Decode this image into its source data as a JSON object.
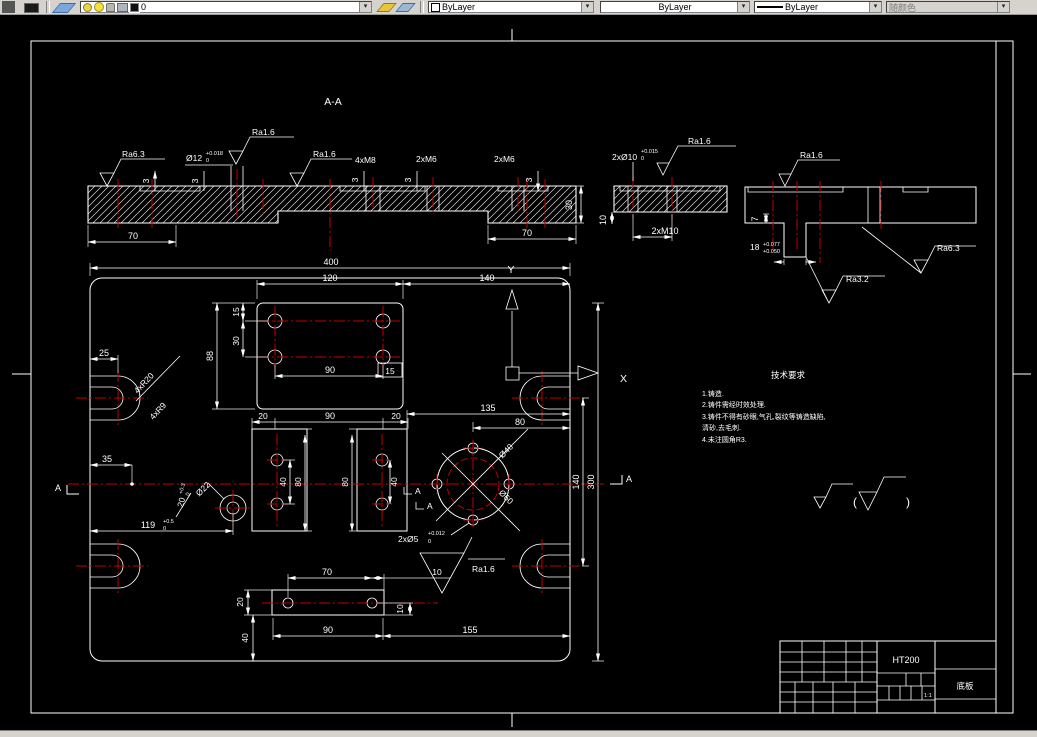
{
  "toolbar": {
    "layer_name": "0",
    "color": "ByLayer",
    "linetype": "ByLayer",
    "lineweight": "ByLayer",
    "plot_style": "随颜色",
    "dropdown_glyph": "▾"
  },
  "section": {
    "title": "A-A",
    "ra63": "Ra6.3",
    "ra16": "Ra1.6",
    "ra32": "Ra3.2",
    "dia12": "Ø12",
    "dia12_up": "+0.018",
    "dia12_dn": "0",
    "m8": "4xM8",
    "m6": "2xM6",
    "m10": "2xM10",
    "dia10": "2xØ10",
    "dia10_up": "+0.015",
    "dia10_dn": "0",
    "d3": "3",
    "d70": "70",
    "d30": "30",
    "d10": "10",
    "d7": "7",
    "d18": "18",
    "d18_up": "+0.077",
    "d18_dn": "+0.050"
  },
  "plan": {
    "d400": "400",
    "d120": "120",
    "d140": "140",
    "d300": "300",
    "d88": "88",
    "d15": "15",
    "d30": "30",
    "d25": "25",
    "d35": "35",
    "d119": "119",
    "d119_up": "+0.5",
    "d119_dn": "0",
    "d20": "20",
    "d20_up": "+0.3",
    "d20_dn": "0",
    "d40": "40",
    "d80": "80",
    "d90": "90",
    "d70": "70",
    "d10": "10",
    "d135": "135",
    "d155": "155",
    "r20": "4xR20",
    "r9": "4xR9",
    "dia40": "Ø40",
    "dia60": "Ø60",
    "dia22": "Ø22",
    "dia5": "2xØ5",
    "dia5_up": "+0.012",
    "dia5_dn": "0",
    "ra16": "Ra1.6",
    "axis_x": "X",
    "axis_y": "Y",
    "section_letter": "A",
    "paren_open": "(",
    "paren_close": ")"
  },
  "notes": {
    "title": "技术要求",
    "lines": [
      "1.铸造.",
      "2.铸件需经时效处理.",
      "3.铸件不得有砂眼,气孔,裂纹等铸造缺陷,",
      "清砂,去毛刺.",
      "4.未注圆角R3."
    ]
  },
  "title_block": {
    "material": "HT200",
    "part_name": "底板",
    "scale": "1:1"
  }
}
